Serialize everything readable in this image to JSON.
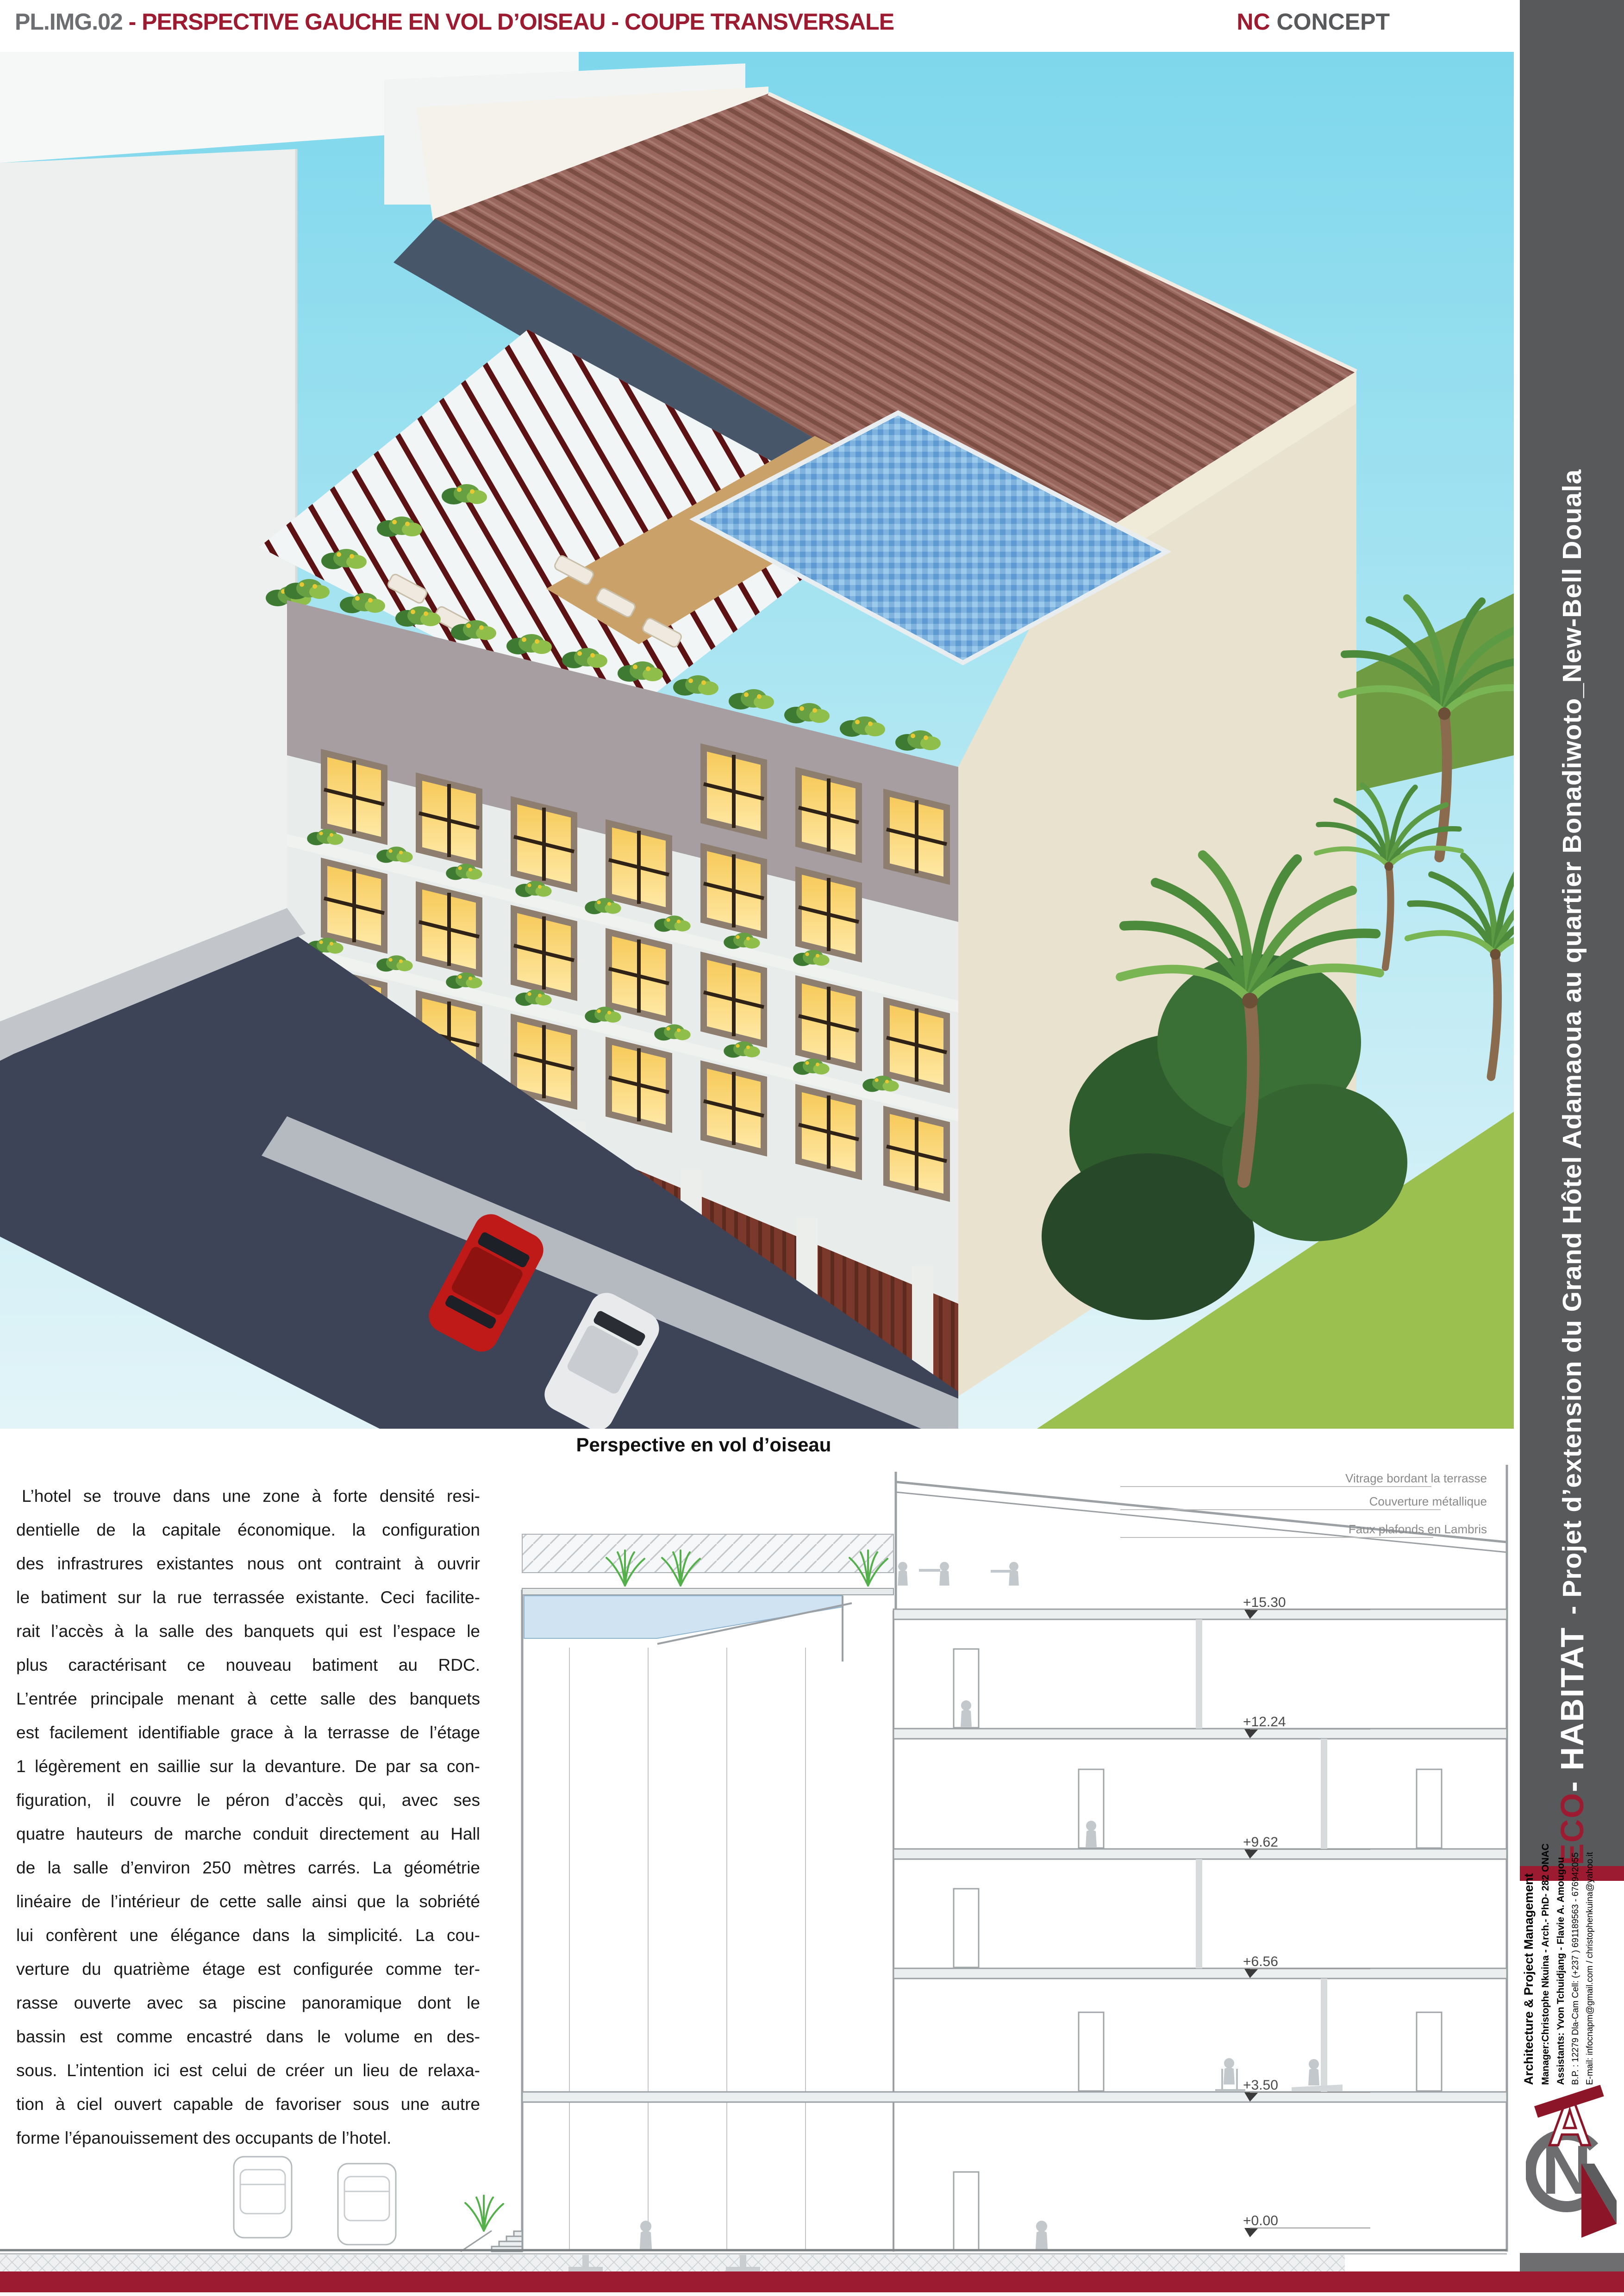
{
  "header": {
    "sheet_code": "PL.IMG.02",
    "title_rest": " - PERSPECTIVE GAUCHE EN VOL D’OISEAU - COUPE TRANSVERSALE",
    "brand_nc": "NC",
    "brand_concept": " CONCEPT"
  },
  "perspective": {
    "caption": "Perspective en vol d’oiseau"
  },
  "description": {
    "lines": [
      "L’hotel se trouve dans une zone à forte densité resi-",
      "dentielle de la capitale économique. la configuration",
      "des infrastrures existantes nous ont contraint à ouvrir",
      "le batiment sur la rue terrassée existante. Ceci facilite-",
      "rait l’accès à la salle des banquets qui est l’espace le",
      "plus caractérisant ce nouveau batiment au RDC.",
      "L’entrée principale menant à cette salle des banquets",
      "est facilement identifiable grace à la terrasse de l’étage",
      "1 légèrement en saillie sur la devanture. De par sa con-",
      "figuration, il couvre le péron d’accès qui, avec ses",
      "quatre hauteurs de marche conduit directement au Hall",
      "de la salle d’environ 250 mètres carrés. La géométrie",
      "linéaire de l’intérieur de cette salle ainsi que la sobriété",
      "lui confèrent une élégance  dans la simplicité. La cou-",
      "verture du  quatrième étage est configurée comme ter-",
      "rasse ouverte avec sa piscine panoramique dont le",
      "bassin est comme encastré dans le volume en des-",
      "sous. L’intention ici est celui de créer un lieu de relaxa-",
      "tion à ciel ouvert capable de favoriser sous une autre",
      "forme l’épanouissement des occupants de l’hotel."
    ]
  },
  "section": {
    "labels": [
      "Vitrage bordant la terrasse",
      "Couverture métallique",
      "Faux plafonds en Lambris"
    ],
    "levels": [
      "+15.30",
      "+12.24",
      "+9.62",
      "+6.56",
      "+3.50",
      "+0.00"
    ]
  },
  "sidebar": {
    "eco": "ECO",
    "habitat": " - HABITAT",
    "project": "- Projet d’extension du Grand Hôtel Adamaoua au quartier Bonadiwoto_New-Bell Douala",
    "firm": "Architecture &  Project Management",
    "manager": "Manager:Christophe Nkuina - Arch.- PhD- 282 ONAC",
    "assistants": "Assistants: Yvon Tchuidjang - Flavie A. Amougou",
    "contact_bp": "B.P. : 12279 Dla-Cam    Cell: (+237 ) 691189563 - 676942055",
    "contact_email": "E-mail: infocnapm@gmail.com  / christophenkuina@yahoo.it"
  },
  "colors": {
    "accent_red": "#9c1b30",
    "sidebar_gray": "#58595b",
    "title_gray": "#6d6e71"
  }
}
